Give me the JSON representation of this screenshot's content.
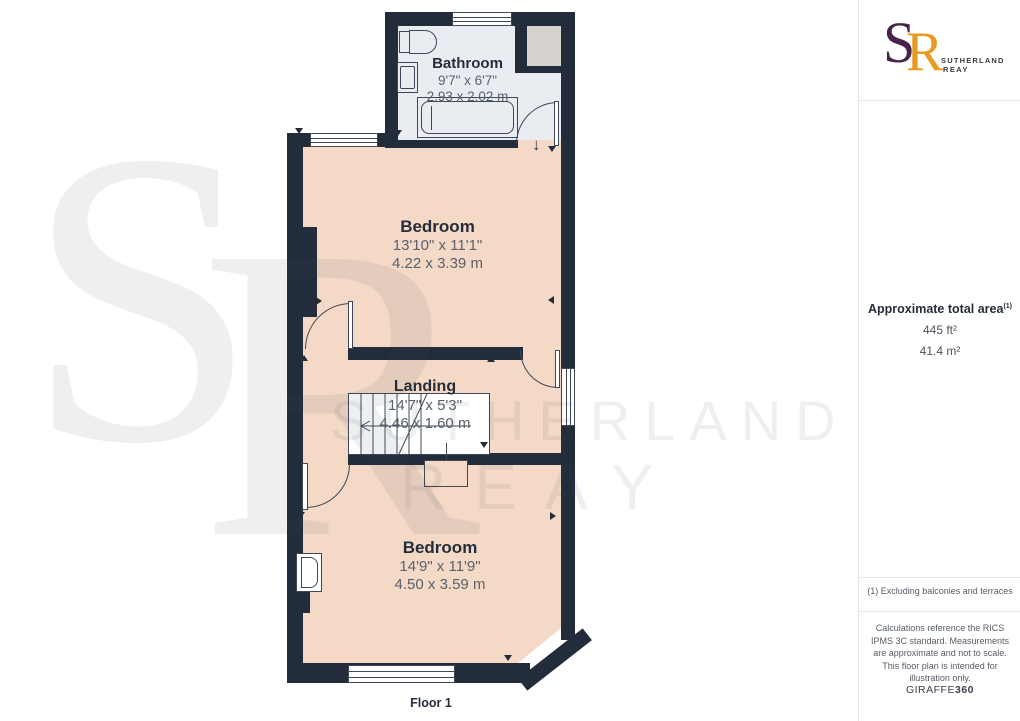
{
  "plan": {
    "floor_label": "Floor 1",
    "rooms": [
      {
        "id": "bathroom",
        "name": "Bathroom",
        "imperial": "9'7\" x 6'7\"",
        "metric": "2.93 x 2.02 m"
      },
      {
        "id": "bedroom-1",
        "name": "Bedroom",
        "imperial": "13'10\" x 11'1\"",
        "metric": "4.22 x 3.39 m"
      },
      {
        "id": "landing",
        "name": "Landing",
        "imperial": "14'7\" x 5'3\"",
        "metric": "4.46 x 1.60 m"
      },
      {
        "id": "bedroom-2",
        "name": "Bedroom",
        "imperial": "14'9\" x 11'9\"",
        "metric": "4.50 x 3.59 m"
      }
    ]
  },
  "watermark": {
    "letter_s": "S",
    "letter_r": "R",
    "line1": "SUTHERLAND",
    "line2": "REAY"
  },
  "sidebar": {
    "logo": {
      "monogram_s": "S",
      "monogram_r": "R",
      "name_line1": "SUTHERLAND",
      "name_line2": "REAY"
    },
    "area": {
      "heading": "Approximate total area",
      "footnote_marker": "(1)",
      "imperial": "445 ft²",
      "metric": "41.4 m²"
    },
    "footnote": "(1) Excluding balconies and terraces",
    "disclaimer": "Calculations reference the RICS IPMS 3C standard. Measurements are approximate and not to scale. This floor plan is intended for illustration only.",
    "brand_prefix": "GIRAFFE",
    "brand_suffix": "360"
  },
  "colors": {
    "wall": "#232c3a",
    "peach": "#f4d9c6",
    "bathfloor": "#e9edf2",
    "voidgray": "#d6d3ce",
    "brand-purple": "#472349",
    "brand-orange": "#e89b22"
  }
}
